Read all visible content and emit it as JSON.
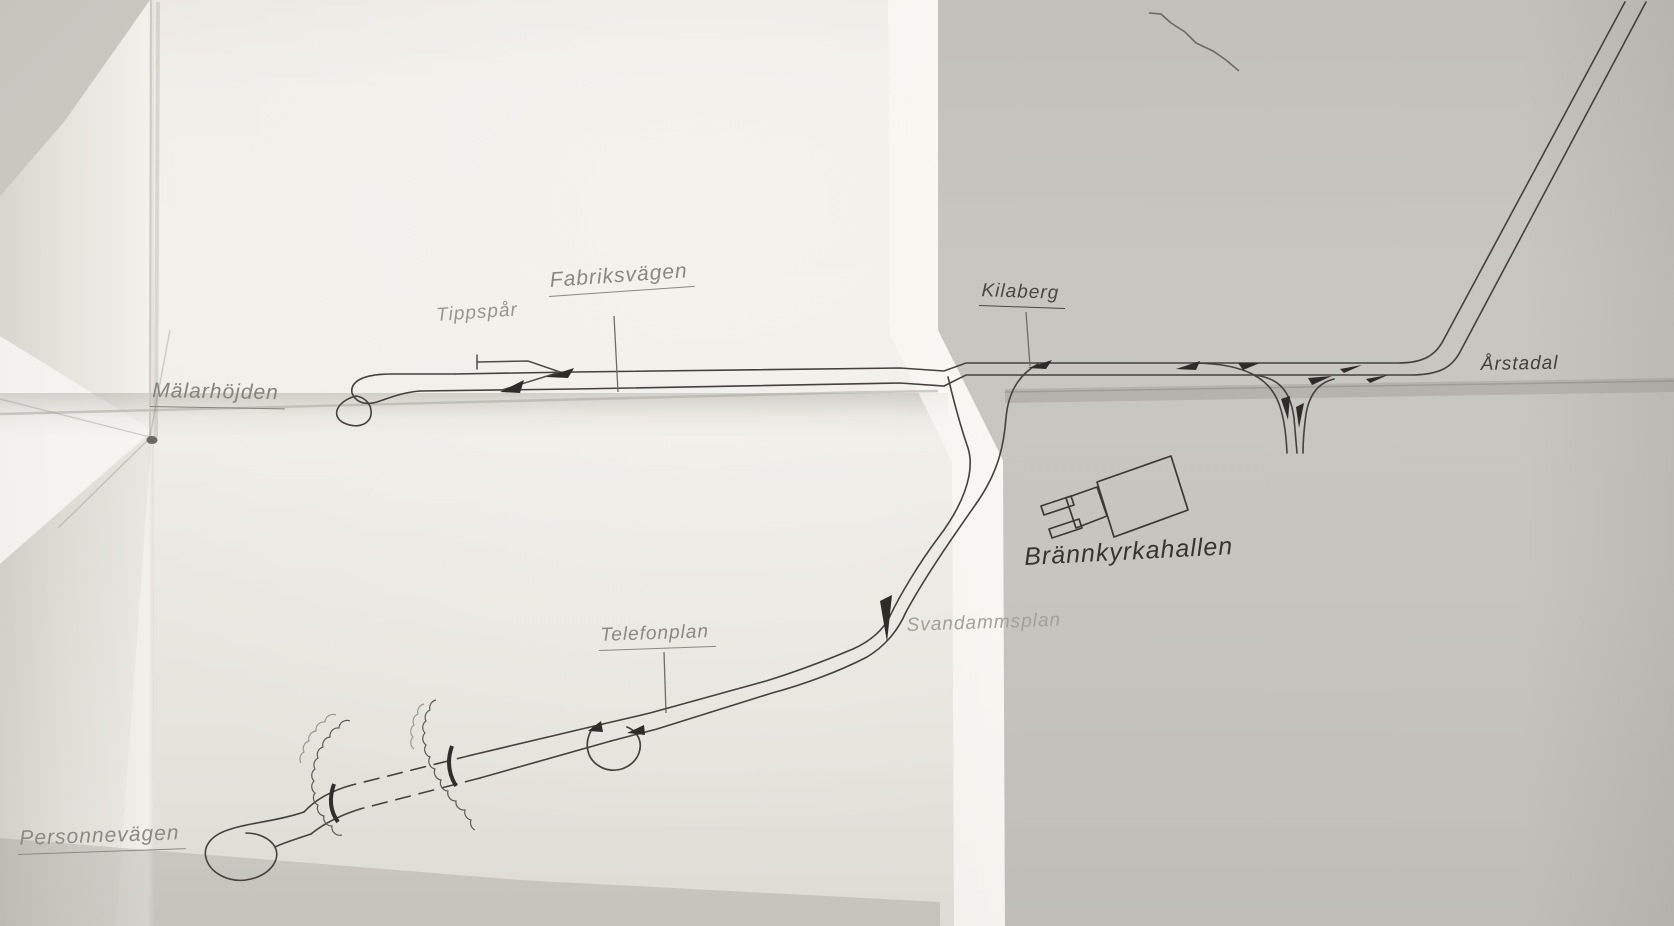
{
  "labels": {
    "malarhojden": {
      "text": "Mälarhöjden"
    },
    "tippspar": {
      "text": "Tippspår"
    },
    "fabriksvagen": {
      "text": "Fabriksvägen"
    },
    "kilaberg": {
      "text": "Kilaberg"
    },
    "arstadal": {
      "text": "Årstadal"
    },
    "brannkyrkahallen": {
      "text": "Brännkyrkahallen"
    },
    "telefonplan": {
      "text": "Telefonplan"
    },
    "svandammsplan": {
      "text": "Svandammsplan"
    },
    "personnevagen": {
      "text": "Personnevägen"
    }
  },
  "colors": {
    "ink": "#45413d",
    "switch_mark": "#2e2b28",
    "pencil": "#8d8a85",
    "paper_light": "#f0eee9",
    "paper_dark": "#c7c4bf"
  }
}
